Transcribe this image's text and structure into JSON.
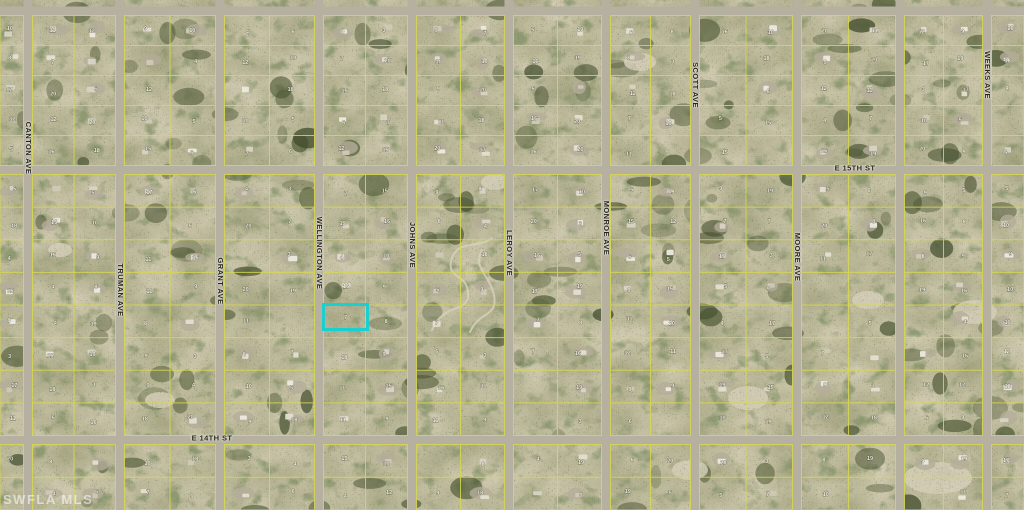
{
  "watermark": "SWFLA MLS",
  "map": {
    "type": "satellite-parcel-map",
    "colors": {
      "highlight": "#17d0cf",
      "parcel_line": "#d8d94f",
      "road": "#b6b0a0",
      "label_text": "#26261c",
      "lot_number": "#f7f4ea",
      "ground_base": "#8f8a67"
    },
    "street_labels": [
      {
        "name": "CANTON AVE",
        "x": 28,
        "y": 148,
        "orientation": "vertical"
      },
      {
        "name": "TRUMAN AVE",
        "x": 120,
        "y": 290,
        "orientation": "vertical"
      },
      {
        "name": "GRANT AVE",
        "x": 220,
        "y": 281,
        "orientation": "vertical"
      },
      {
        "name": "WELLINGTON AVE",
        "x": 319,
        "y": 253,
        "orientation": "vertical"
      },
      {
        "name": "JOHNS AVE",
        "x": 412,
        "y": 245,
        "orientation": "vertical"
      },
      {
        "name": "LEROY AVE",
        "x": 509,
        "y": 253,
        "orientation": "vertical"
      },
      {
        "name": "MONROE AVE",
        "x": 606,
        "y": 228,
        "orientation": "vertical"
      },
      {
        "name": "SCOTT AVE",
        "x": 695,
        "y": 85,
        "orientation": "vertical"
      },
      {
        "name": "MOORE AVE",
        "x": 797,
        "y": 257,
        "orientation": "vertical"
      },
      {
        "name": "WEEKS AVE",
        "x": 987,
        "y": 75,
        "orientation": "vertical"
      },
      {
        "name": "E 15TH ST",
        "x": 855,
        "y": 168,
        "orientation": "horizontal"
      },
      {
        "name": "E 14TH ST",
        "x": 212,
        "y": 438,
        "orientation": "horizontal"
      }
    ],
    "highlighted_parcel": {
      "x": 322,
      "y": 303,
      "width": 47,
      "height": 28,
      "lot_label": "7"
    },
    "layout": {
      "width": 1024,
      "height": 510,
      "vertical_roads": [
        28,
        120,
        220,
        319,
        412,
        509,
        606,
        695,
        797,
        900,
        987
      ],
      "horizontal_roads": [
        11,
        170,
        440
      ],
      "road_width": 9
    },
    "lot_number_samples": [
      7,
      8,
      9,
      10,
      11,
      12,
      15,
      16,
      17,
      18,
      19,
      20,
      3,
      4,
      5,
      6
    ]
  }
}
